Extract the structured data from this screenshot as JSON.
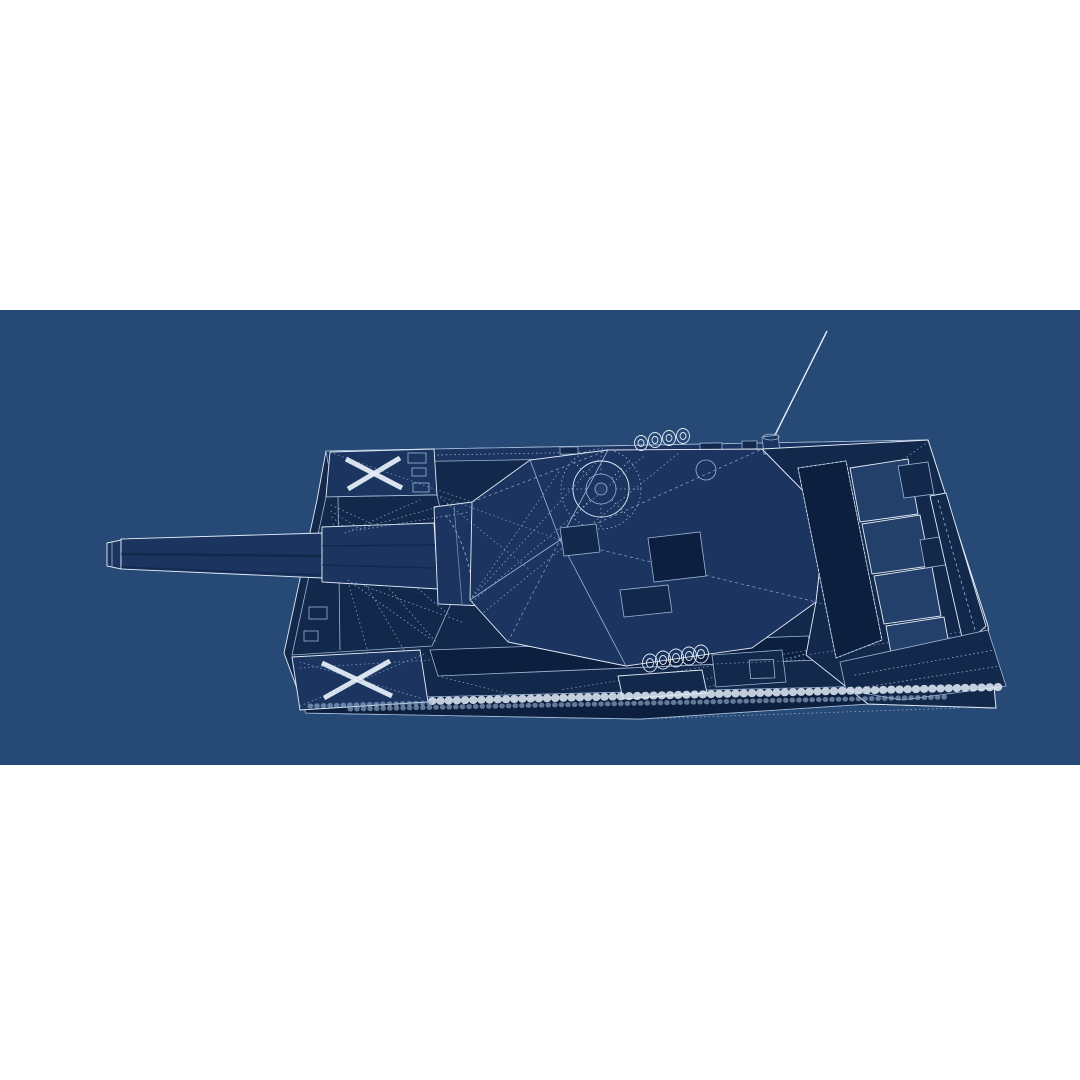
{
  "image": {
    "subject": "Blueprint-style 3D wireframe render of a main battle tank viewed from above at an oblique angle, gun barrel pointing left, on a solid blue canvas with white letterbox bands above and below",
    "colors": {
      "page_background": "#ffffff",
      "canvas_background": "#264a75",
      "model_fill_deep": "#0c1f3e",
      "model_fill_dark": "#13294c",
      "model_fill_mid": "#1b3560",
      "model_fill_light": "#23406a",
      "wire_light": "#e4edf8",
      "wire_mid": "#9cb5d5"
    },
    "parts": [
      "gun barrel",
      "muzzle",
      "bore evacuator sleeve",
      "gun mantlet",
      "turret",
      "commander cupola",
      "turret hatches",
      "smoke grenade launcher coils",
      "radio antenna",
      "hull",
      "glacis",
      "front fender panel with X marking",
      "rear fender panel with X marking",
      "engine deck",
      "louvered engine grilles",
      "engine access hatch",
      "stowage rail",
      "side vent",
      "roadwheel coils",
      "track link chains",
      "construction wireframe lines"
    ]
  }
}
